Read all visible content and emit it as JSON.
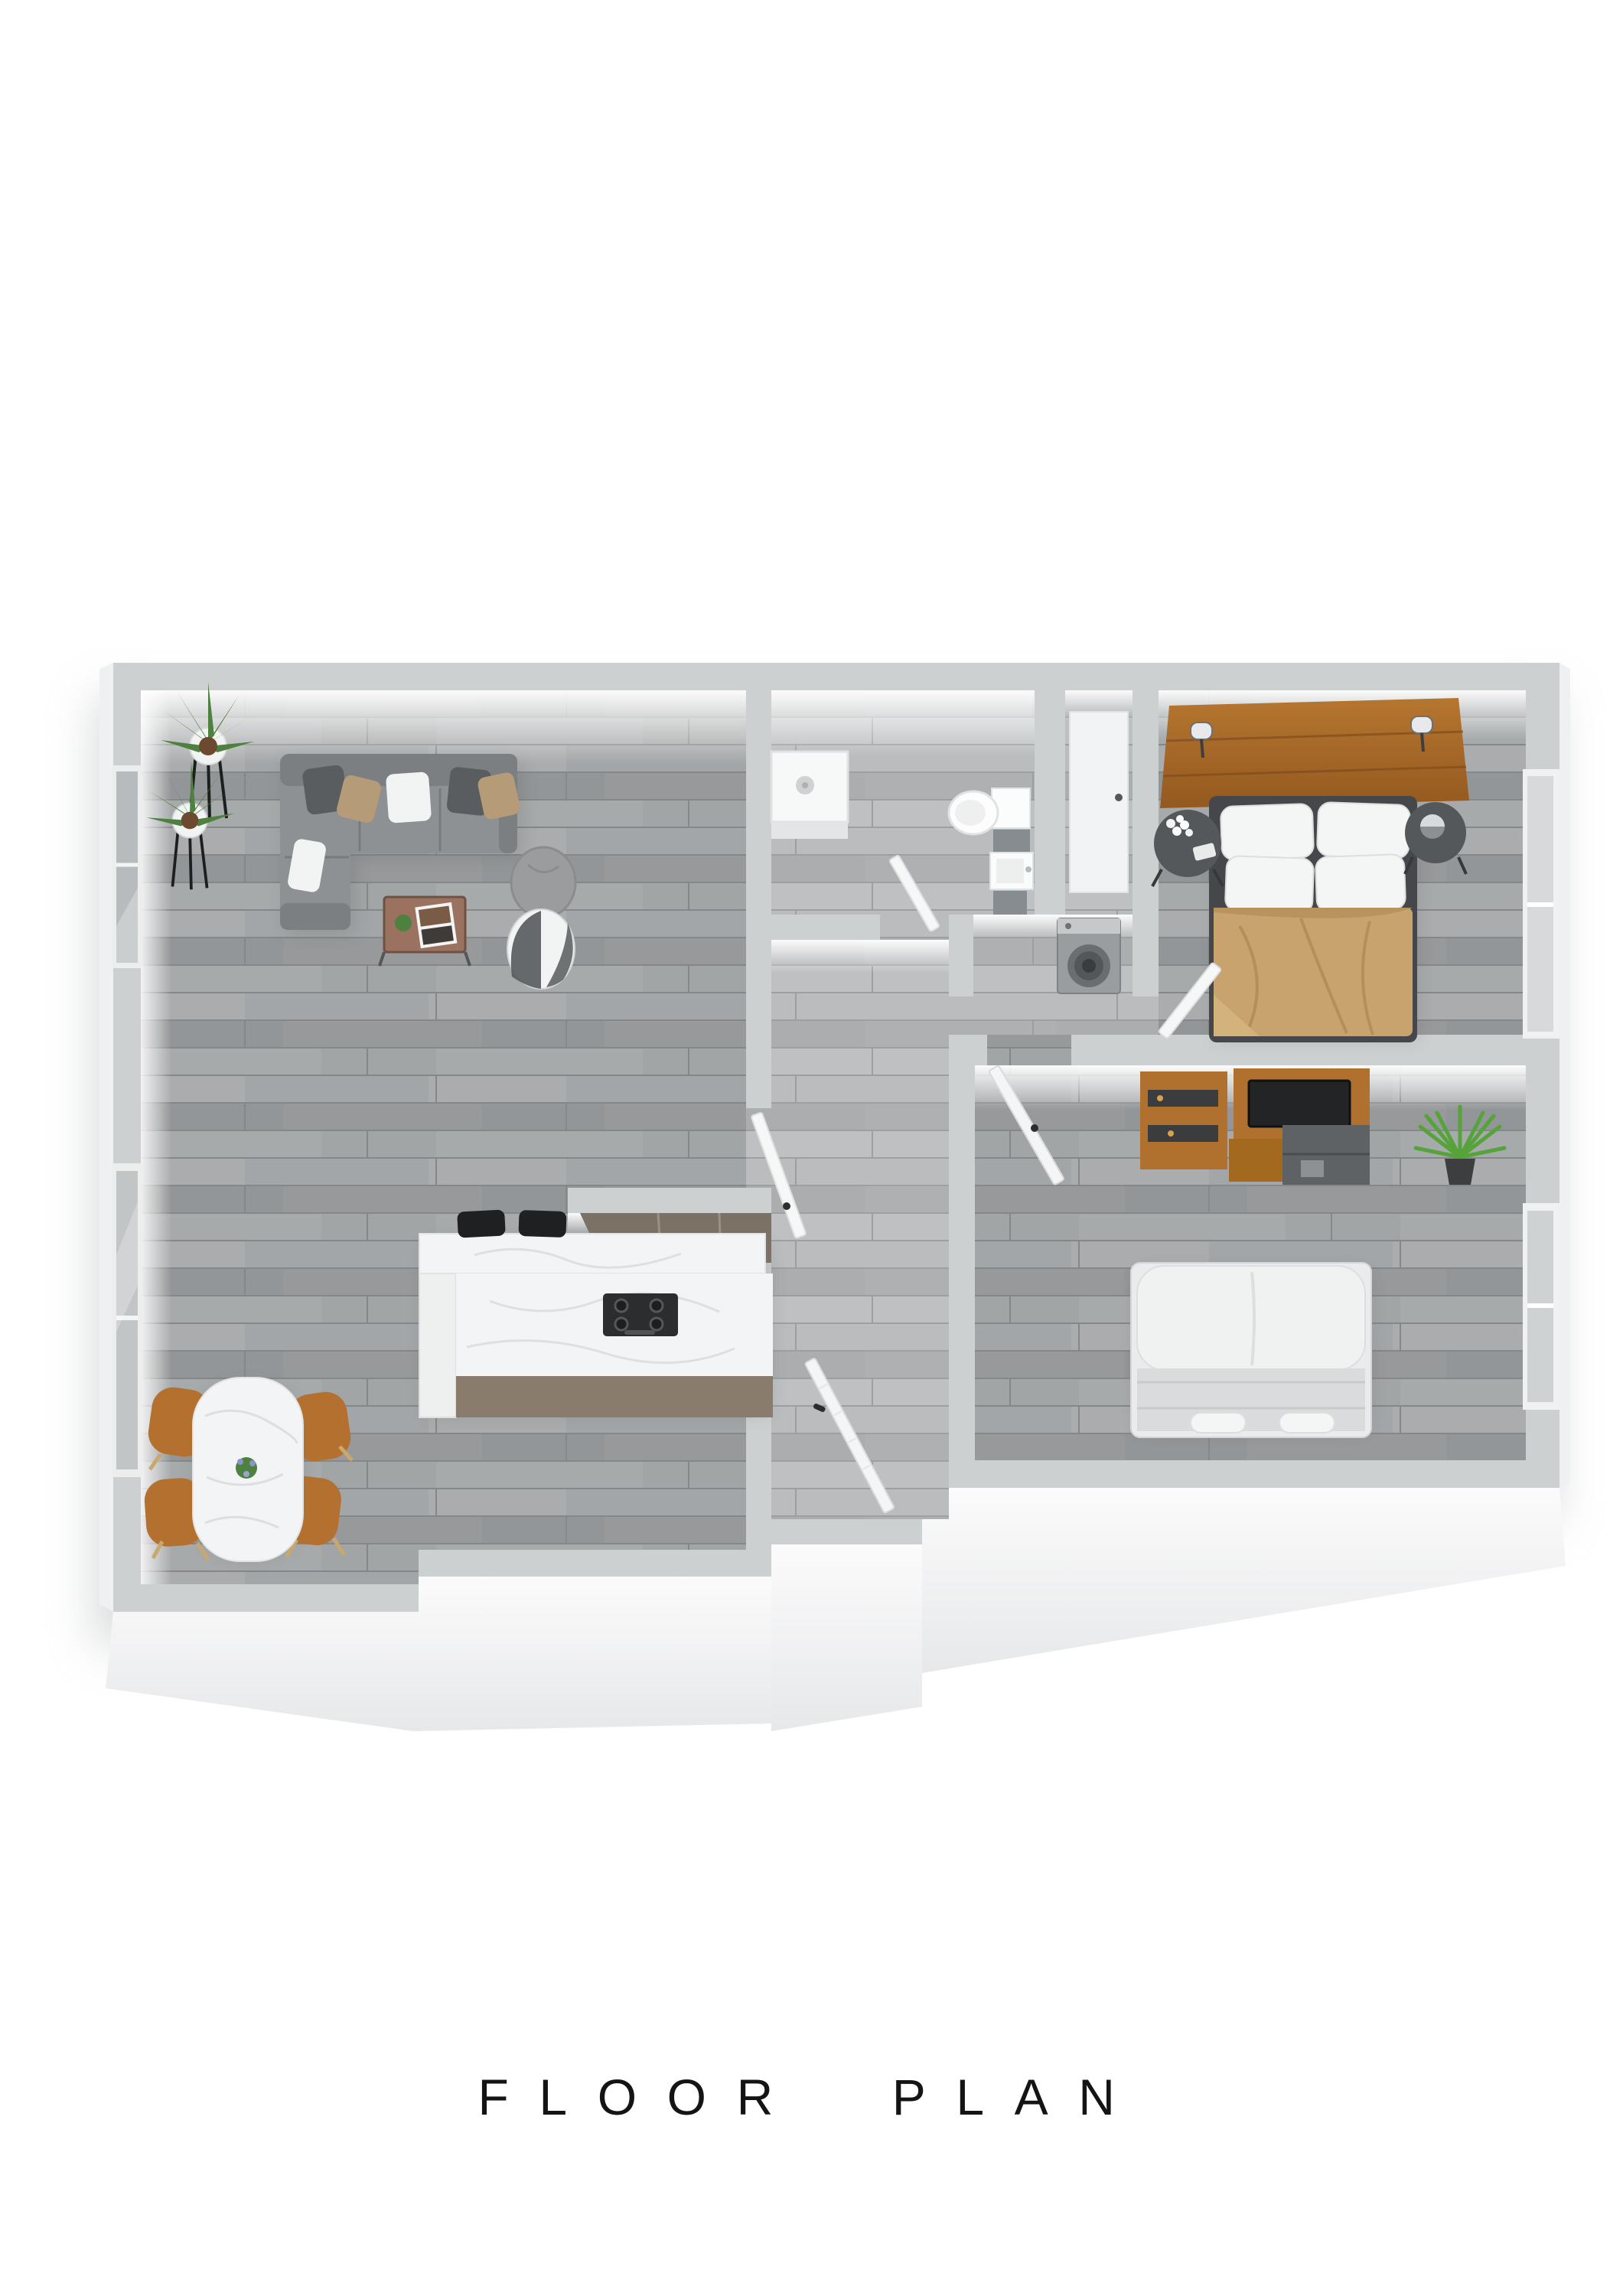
{
  "title": "FLOOR  PLAN",
  "palette": {
    "wall_cap": "#cdd0d1",
    "wall_face_light": "#f1f2f3",
    "floor_main": "#9da0a2",
    "floor_light": "#b4b6b8",
    "sofa_gray": "#8e9193",
    "sofa_dark": "#7c7f82",
    "pillow_dark": "#5a5d5f",
    "pillow_tan": "#b59b78",
    "pillow_white": "#f2f3f3",
    "coffee_table_brown": "#9b7260",
    "marble_white": "#f3f4f5",
    "counter_base_taupe": "#8a7c6c",
    "cooktop_black": "#2c2d2f",
    "stool_black": "#1e2021",
    "chair_caramel": "#b4702e",
    "plant_green": "#4e8040",
    "plant_bright_green": "#57a33b",
    "headboard_wood": "#b0712f",
    "bed_frame_dark": "#45474a",
    "duvet_tan": "#c8a36e",
    "nightstand_gray": "#55585b",
    "tv_black": "#222426",
    "tile_gray": "#878c90",
    "washer_gray": "#9a9d9f",
    "bed2_white": "#e9ebec",
    "glass_gray": "#b7bbbd"
  },
  "scene": {
    "rooms": [
      {
        "name": "living-dining-kitchen",
        "furniture": [
          "sectional-sofa",
          "throw-pillows",
          "floor-plants",
          "coffee-table",
          "magazine",
          "pouf",
          "beanbag",
          "kitchen-island",
          "bar-stools",
          "gas-cooktop",
          "range-hood",
          "dining-table",
          "dining-chairs",
          "flower-centerpiece",
          "window-wall"
        ]
      },
      {
        "name": "bathroom",
        "furniture": [
          "shower-tray",
          "toilet",
          "sink-vanity",
          "tiled-ledges",
          "bathroom-door"
        ]
      },
      {
        "name": "hallway",
        "furniture": [
          "entry-door",
          "kitchen-hall-door",
          "hall-closet-door"
        ]
      },
      {
        "name": "laundry-closet",
        "furniture": [
          "washing-machine"
        ]
      },
      {
        "name": "master-bedroom",
        "furniture": [
          "wood-headboard",
          "reading-sconces",
          "double-bed",
          "white-pillows",
          "tan-duvet",
          "round-nightstands",
          "flower-vase",
          "table-lamp",
          "window"
        ]
      },
      {
        "name": "bedroom-2",
        "furniture": [
          "tv-wall-unit",
          "television",
          "desk-console",
          "shelf-boxes",
          "floor-plant",
          "upholstered-bed",
          "rolled-towels",
          "bedroom-door",
          "window"
        ]
      }
    ]
  }
}
